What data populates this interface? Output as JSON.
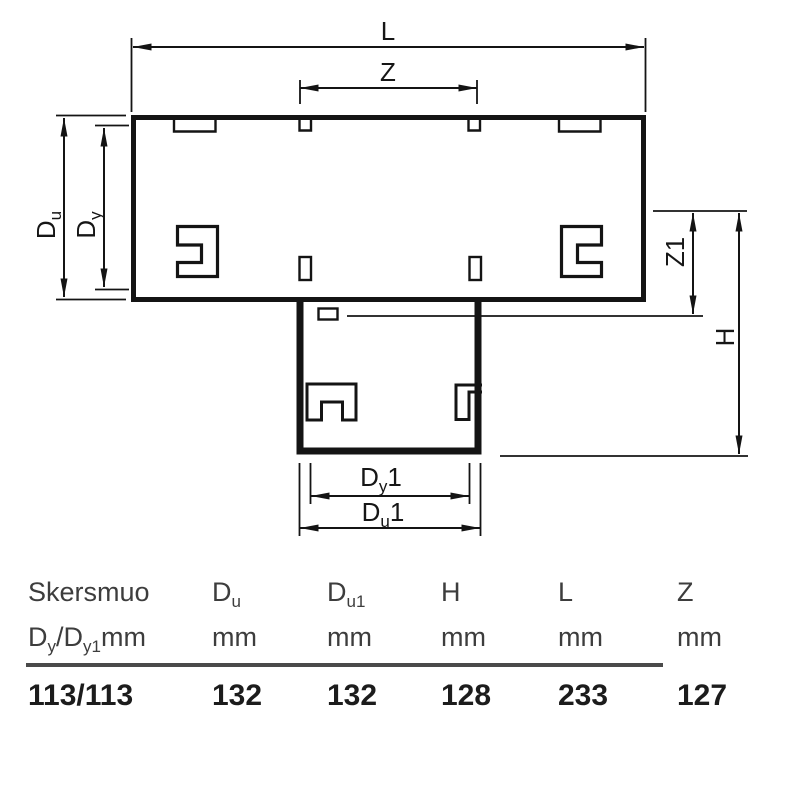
{
  "diagram": {
    "line_color": "#141414",
    "labels": {
      "l": "L",
      "z": "Z",
      "z1": "Z1",
      "h": "H",
      "du_main": "D",
      "du_sub": "u",
      "dy_main": "D",
      "dy_sub": "y",
      "dy1_main": "D",
      "dy1_sub": "y",
      "dy1_suffix": "1",
      "du1_main": "D",
      "du1_sub": "u",
      "du1_suffix": "1"
    }
  },
  "table": {
    "rule_color": "#4a4a4a",
    "columns": [
      {
        "h1": "Skersmuo",
        "h2_m1": "D",
        "h2_s1": "y",
        "h2_m2": "/D",
        "h2_s2": "y1",
        "h2_m3": "mm",
        "value": "113/113"
      },
      {
        "h1_main": "D",
        "h1_sub": "u",
        "h2": "mm",
        "value": "132"
      },
      {
        "h1_main": "D",
        "h1_sub": "u1",
        "h2": "mm",
        "value": "132"
      },
      {
        "h1": "H",
        "h2": "mm",
        "value": "128"
      },
      {
        "h1": "L",
        "h2": "mm",
        "value": "233"
      },
      {
        "h1": "Z",
        "h2": "mm",
        "value": "127"
      }
    ]
  }
}
